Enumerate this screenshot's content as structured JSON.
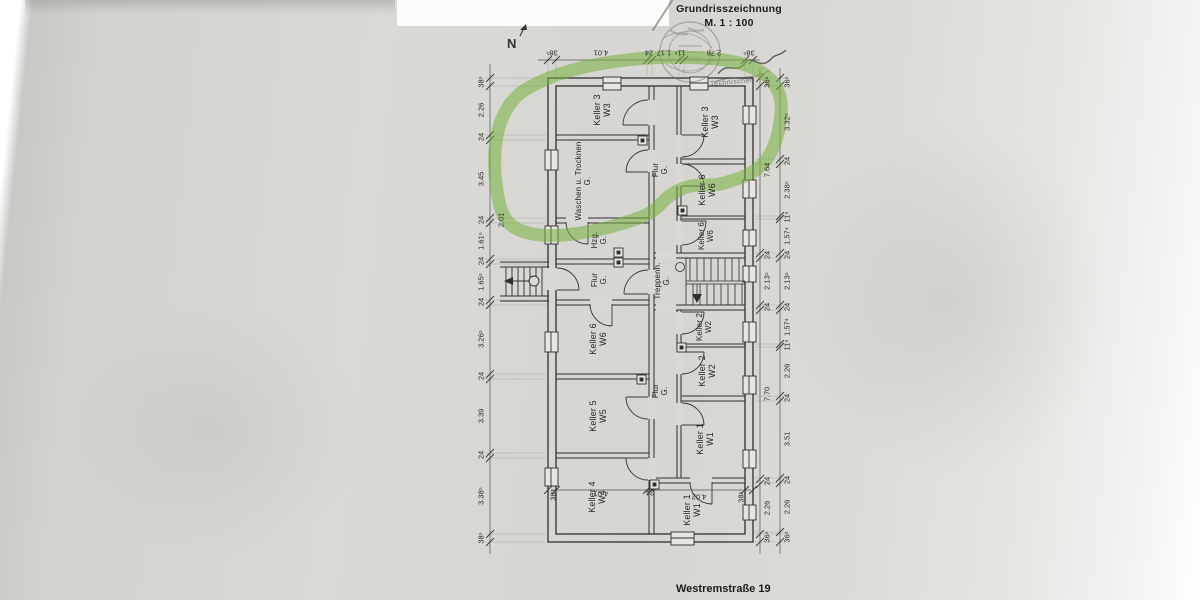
{
  "document": {
    "title_line1": "Grundrisszeichnung",
    "title_line2": "M. 1 : 100",
    "address": "Westremstraße 19",
    "compass_label": "N",
    "stamp_note": "Technischer"
  },
  "rooms": [
    {
      "name": "Keller 3",
      "unit": "W3"
    },
    {
      "name": "Keller 3",
      "unit": "W3"
    },
    {
      "name": "Flur",
      "unit": "G."
    },
    {
      "name": "Waschen u. Trocknen",
      "unit": "G."
    },
    {
      "name": "Keller 6",
      "unit": "W6"
    },
    {
      "name": "Keller 6",
      "unit": "W6"
    },
    {
      "name": "Hzg.",
      "unit": "G."
    },
    {
      "name": "Flur",
      "unit": "G."
    },
    {
      "name": "Treppenh.",
      "unit": "G."
    },
    {
      "name": "Keller 6",
      "unit": "W6"
    },
    {
      "name": "Keller 2",
      "unit": "W2"
    },
    {
      "name": "Keller 2",
      "unit": "W2"
    },
    {
      "name": "Keller 5",
      "unit": "W5"
    },
    {
      "name": "Flur",
      "unit": "G."
    },
    {
      "name": "Keller 1",
      "unit": "W1"
    },
    {
      "name": "Keller 4",
      "unit": "W4"
    },
    {
      "name": "Keller 1",
      "unit": "W1"
    }
  ],
  "dims": {
    "top": [
      "38⁵",
      "4.01",
      "24",
      "1.17",
      "11⁵",
      "2.76",
      "38⁵"
    ],
    "left": [
      "38⁵",
      "2.26",
      "24",
      "3.45",
      "24",
      "1.61⁵",
      "24",
      "1.65⁵",
      "24",
      "3.26⁵",
      "24",
      "3.39",
      "24",
      "3.38⁵",
      "38⁵"
    ],
    "left_inner": "2.01",
    "right_inner": [
      "36⁵",
      "7.64",
      "24",
      "2.13⁵",
      "24",
      "7.70",
      "24",
      "2.26",
      "36⁵"
    ],
    "right_outer": [
      "36⁵",
      "3.32⁵",
      "24",
      "2.38⁵",
      "11⁵",
      "1.57⁴",
      "24",
      "2.13⁵",
      "24",
      "1.57⁴",
      "11⁵",
      "2.26",
      "24",
      "3.51",
      "24",
      "2.26",
      "36⁵"
    ],
    "bottom": [
      "38⁵",
      "4.01",
      "24",
      "4.02",
      "38⁵"
    ]
  },
  "colors": {
    "marker_green": "#76b03c",
    "ink": "#2f2f2f",
    "paper": "#d9d8d4"
  }
}
